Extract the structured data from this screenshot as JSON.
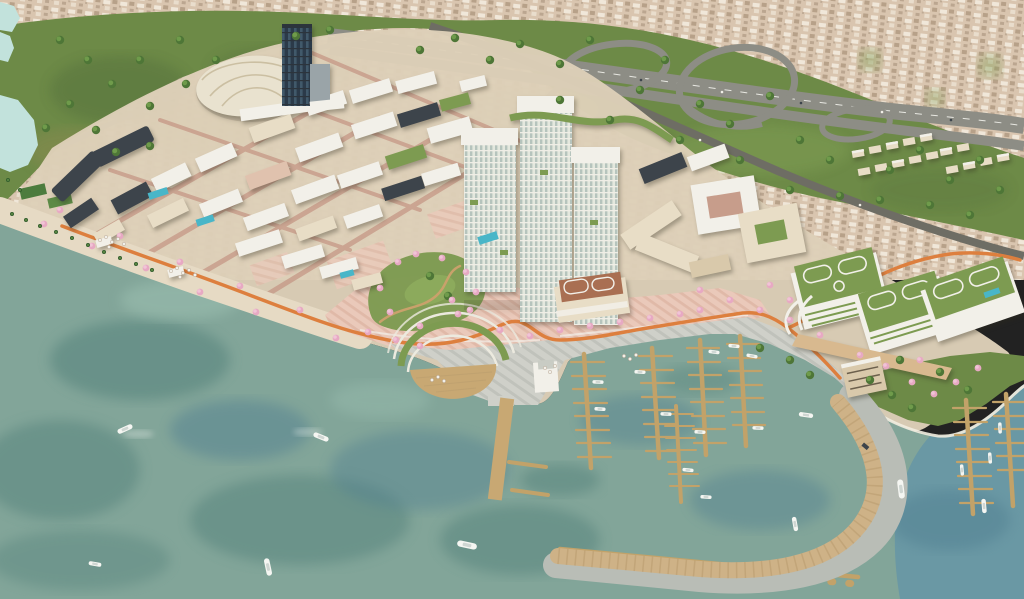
{
  "scene": {
    "type": "aerial-architectural-rendering",
    "title": "Aerial rendering of a waterfront mixed-use masterplan with marina",
    "description": "Bird's-eye architectural visualization: a new district of cream mid-rise blocks, white roofs and high-rise towers sits between an existing beige city, a hillside park crossed by a highway with looping interchange ramps, and a teal bay. The waterfront has a pink paved plaza, cherry-blossom promenade, orange winding path, amphitheater steps with a timber deck, a marina of wooden docks with white yachts, and a curved boardwalk breakwater. A domed hall, a dark glass tower and a terraced green-roof complex anchor the plan.",
    "regions": [
      {
        "id": "existing-city",
        "label": "Existing dense city fabric"
      },
      {
        "id": "park",
        "label": "Hillside park with mature trees"
      },
      {
        "id": "lake",
        "label": "Park lakes"
      },
      {
        "id": "highway-interchange",
        "label": "Highway with looping interchange ramps"
      },
      {
        "id": "district",
        "label": "New mixed-use district"
      },
      {
        "id": "dome-hall",
        "label": "Domed event hall"
      },
      {
        "id": "glass-tower",
        "label": "Dark glass office tower"
      },
      {
        "id": "central-towers",
        "label": "Cream high-rise towers"
      },
      {
        "id": "green-roof-complex",
        "label": "Terraced complex with landscaped green roofs"
      },
      {
        "id": "promenade",
        "label": "Waterfront promenade with cherry blossoms"
      },
      {
        "id": "plaza",
        "label": "Pink paved waterfront plaza"
      },
      {
        "id": "orange-path",
        "label": "Orange winding cycle path"
      },
      {
        "id": "amphitheater",
        "label": "Waterside amphitheater steps and timber deck"
      },
      {
        "id": "marina",
        "label": "Marina with timber docks and yachts"
      },
      {
        "id": "boardwalk",
        "label": "Curved timber boardwalk breakwater"
      },
      {
        "id": "beach",
        "label": "Sandy beach with palm trees"
      },
      {
        "id": "bay",
        "label": "Teal bay water with boats"
      }
    ]
  },
  "colors": {
    "cityBase": "#d9c5af",
    "citySpeckleLight": "#f0e7d9",
    "citySpeckleDark": "#b7a189",
    "cityShadow": "#a6917b",
    "parkGreen": "#6d8a47",
    "parkDark": "#55703c",
    "parkOlive": "#8f8a52",
    "lawnGreen": "#7b9a4f",
    "lawnLight": "#8fae5e",
    "treeGreen": "#4e7637",
    "treeLight": "#6f9b4b",
    "palmGreen": "#35602f",
    "lake": "#c2e2dc",
    "roadGray": "#8d8d85",
    "roadDark": "#6e6d64",
    "laneWhite": "#e8e8e2",
    "roadLight": "#a9a396",
    "waterBase": "#82a599",
    "waterDark": "#54827b",
    "waterBlue": "#4f7e90",
    "waterLight": "#9cc0b1",
    "waterRight": "#6695a6",
    "sand": "#e7dbc4",
    "sandLight": "#f0e8d2",
    "platform": "#ddd0b8",
    "promenade": "#e6dac4",
    "plazaPink": "#eac9ba",
    "plazaStripe": "#ddb5a4",
    "quayGray": "#cfd0c9",
    "quayStripe": "#bfc1ba",
    "pathOrange": "#dd7f3e",
    "pathTan": "#c9a16b",
    "blossom": "#e7a9c3",
    "blossomLight": "#f0c4d6",
    "roofWhite": "#f2f0e9",
    "cream": "#e8ddc6",
    "creamDark": "#d9c9ab",
    "pinkFacade": "#e0c2ae",
    "facadeDark": "#3d444b",
    "facadeDarker": "#2c343c",
    "metal": "#9aa4a8",
    "glassDark": "#2b3a49",
    "glassStripe": "#466072",
    "towerBase": "#e4e8de",
    "towerMullion": "#b6c4bd",
    "towerFloor": "#f0eee6",
    "brickStreet": "#c79d8b",
    "greenRoof": "#7d9b51",
    "terracotta": "#a96f52",
    "domeCream": "#e9e2cf",
    "domeRib": "#cbbfa2",
    "dockWood": "#c2a269",
    "boardWood": "#ceb287",
    "boardGray": "#b9bdb6",
    "pierWood": "#c8a873",
    "plankDark": "#b89b6d",
    "boatWhite": "#f5f6f2",
    "boatDeck": "#cfd6d2",
    "pool": "#49b6c8",
    "forecourt": "#d8b98f",
    "courtGreen": "#4c7c3e",
    "bankEdge": "#f2ede0",
    "arcWhite": "#eceadf"
  }
}
